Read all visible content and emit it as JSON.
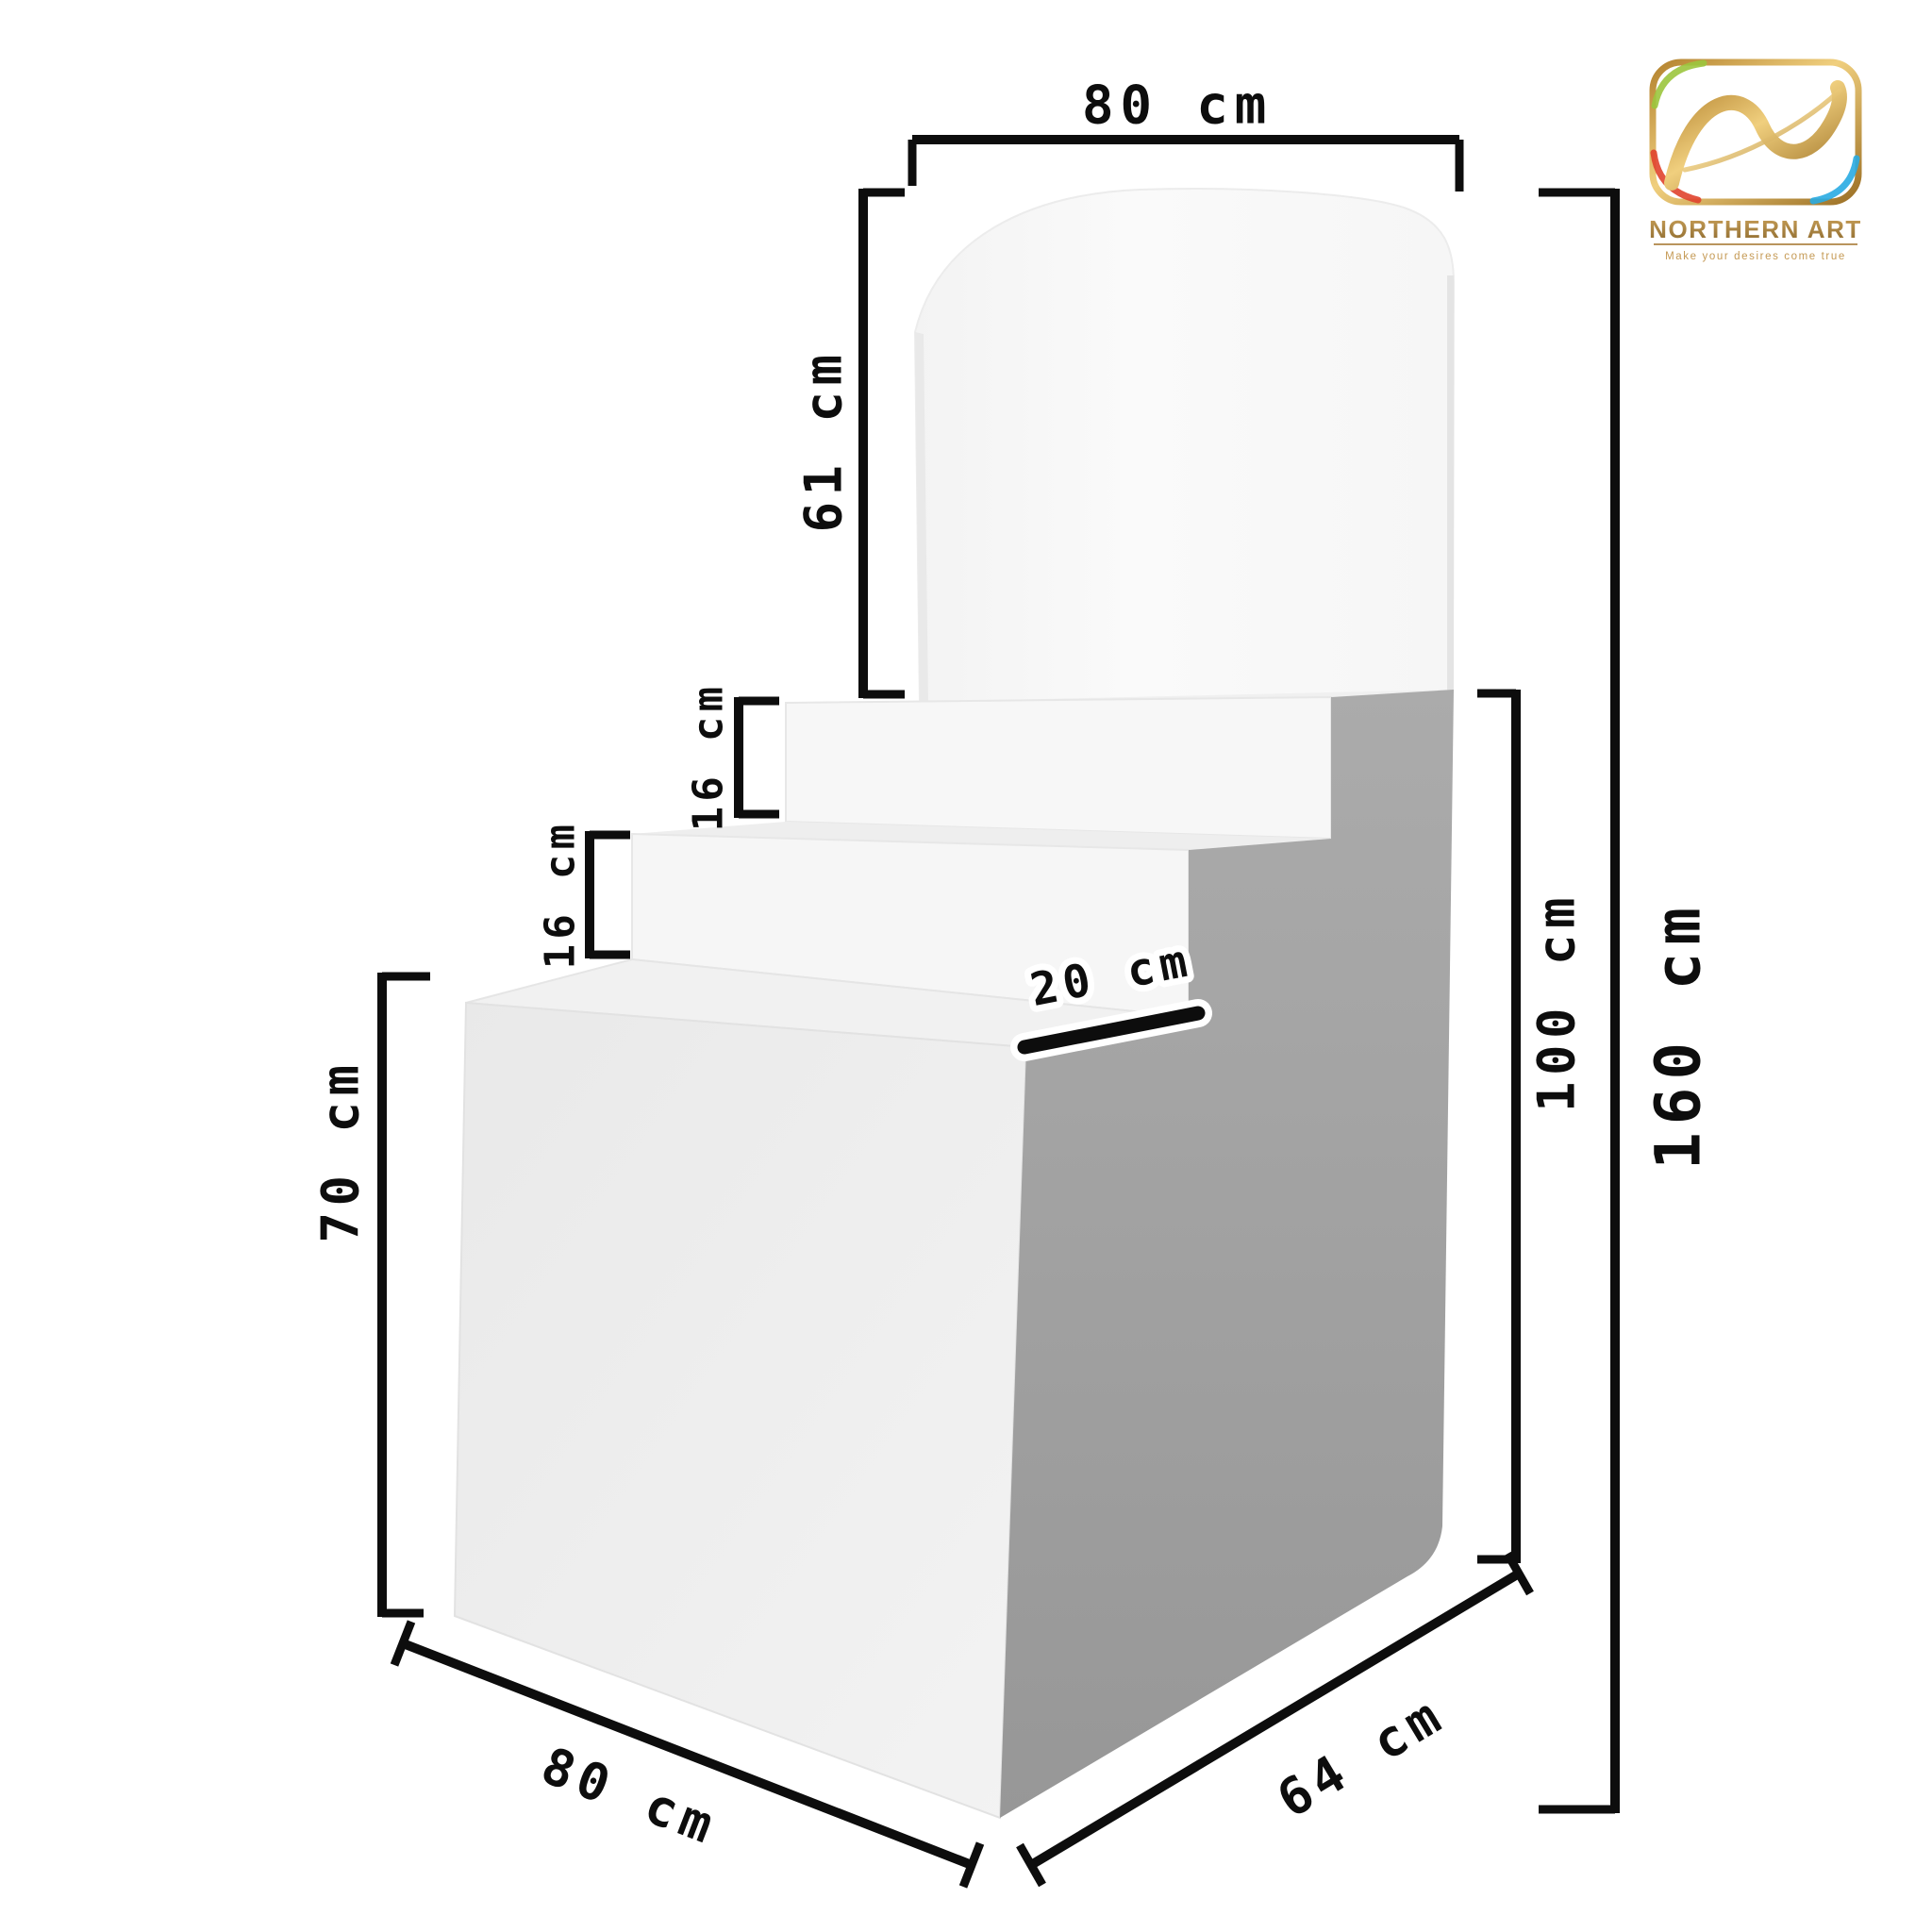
{
  "logo": {
    "title": "NORTHERN ART",
    "tagline": "Make your desires come true",
    "gold": "#c79a4b",
    "gold_dark": "#8d6a2f"
  },
  "diagram": {
    "type": "product-dimension-diagram",
    "product": "tiered display stand with arched backboard",
    "dimensions": {
      "top_width": "80 cm",
      "backboard_height": "61 cm",
      "upper_step_height": "16 cm",
      "lower_step_height": "16 cm",
      "base_height": "70 cm",
      "step_depth": "20 cm",
      "base_width": "80 cm",
      "base_depth": "64 cm",
      "upper_section_height": "100 cm",
      "total_height": "160 cm"
    },
    "colors": {
      "front_face": "#ededed",
      "riser_face": "#f6f6f6",
      "tread_face": "#f0f0f0",
      "backboard_face": "#f9f9f9",
      "side_shadow": "#a2a2a2",
      "annotation": "#0d0d0d"
    }
  }
}
